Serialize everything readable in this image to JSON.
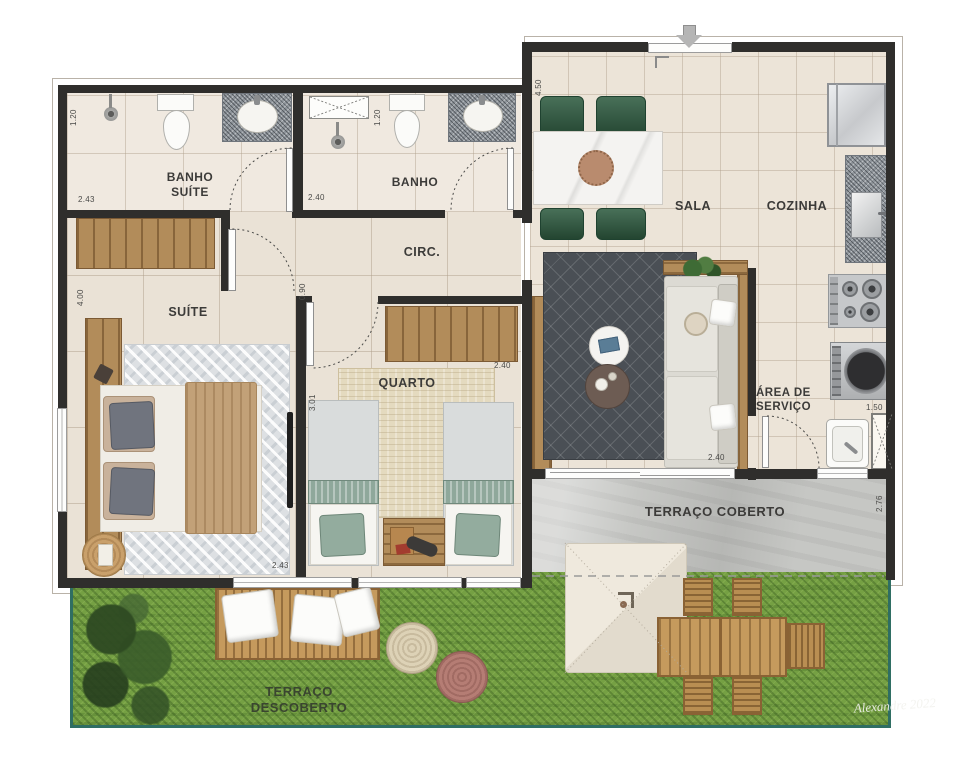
{
  "plan": {
    "type": "apartment floor plan",
    "rooms": {
      "banho_suite": {
        "l1": "BANHO",
        "l2": "SUÍTE"
      },
      "banho": {
        "l1": "BANHO"
      },
      "circ": {
        "l1": "CIRC."
      },
      "suite": {
        "l1": "SUÍTE"
      },
      "quarto": {
        "l1": "QUARTO"
      },
      "sala": {
        "l1": "SALA"
      },
      "cozinha": {
        "l1": "COZINHA"
      },
      "area_servico": {
        "l1": "ÁREA DE",
        "l2": "SERVIÇO"
      },
      "terraco_coberto": {
        "l1": "TERRAÇO COBERTO"
      },
      "terraco_descoberto": {
        "l1": "TERRAÇO DESCOBERTO"
      }
    },
    "measurements": {
      "banho_suite_depth": "1.20",
      "banho_suite_width": "2.43",
      "banho_depth": "1.20",
      "banho_width": "2.40",
      "sala_depth": "4.50",
      "suite_depth": "4.00",
      "suite_width": "2.43",
      "quarto_depth": "3.01",
      "quarto_width": "2.40",
      "circ_door_width": "0.90",
      "sala_living_width": "2.40",
      "area_servico_width": "1.50",
      "terraco_coberto_depth": "2.76"
    },
    "signature": "Alexandre 2022",
    "colors": {
      "wall": "#2f2e2c",
      "floor_tile": "#eae2d6",
      "concrete": "#c6c7c4",
      "grass": "#75a043",
      "garden_border": "#2f6e63",
      "chair_green": "#2f5c41",
      "wood": "#b28c5a"
    }
  }
}
